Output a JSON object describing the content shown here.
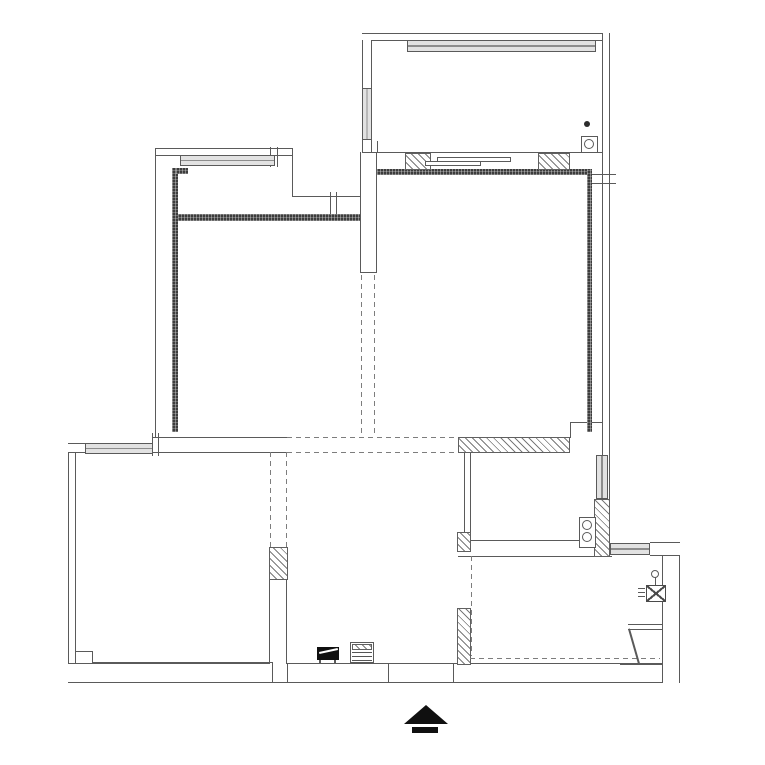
{
  "title": "apartment-floor-plan",
  "canvas": {
    "width": 765,
    "height": 765,
    "background": "#ffffff"
  },
  "colors": {
    "thin_line": "#5a5a5a",
    "stipple_wall": "#3c3c3c",
    "hatch_line": "#7a7a7a",
    "window_fill": "#e2e2e2",
    "dash_line": "#7d7d7d",
    "symbol_black": "#101010"
  },
  "elements": [
    {
      "cls": "band-h",
      "x": 362,
      "y": 33,
      "w": 248,
      "h": 8,
      "name": "balcony-north-wall"
    },
    {
      "cls": "band-v",
      "x": 602,
      "y": 33,
      "w": 8,
      "h": 510,
      "name": "east-outer-wall"
    },
    {
      "cls": "band-v",
      "x": 362,
      "y": 40,
      "w": 10,
      "h": 49,
      "name": "balcony-west-wall-upper"
    },
    {
      "cls": "band-v",
      "x": 362,
      "y": 139,
      "w": 10,
      "h": 14,
      "name": "balcony-west-wall-lower"
    },
    {
      "cls": "band-h",
      "x": 155,
      "y": 148,
      "w": 137,
      "h": 8,
      "name": "bedroom1-north-wall"
    },
    {
      "cls": "band-v",
      "x": 68,
      "y": 443,
      "w": 8,
      "h": 240,
      "name": "west-outer-wall"
    },
    {
      "cls": "band-h",
      "x": 68,
      "y": 663,
      "w": 612,
      "h": 20,
      "name": "south-outer-wall"
    },
    {
      "cls": "band-h",
      "x": 68,
      "y": 443,
      "w": 18,
      "h": 10,
      "name": "sw-corner-wall"
    },
    {
      "cls": "band-v",
      "x": 662,
      "y": 556,
      "w": 18,
      "h": 127,
      "name": "kitchen-east-wall"
    },
    {
      "cls": "band-h",
      "x": 650,
      "y": 542,
      "w": 30,
      "h": 14,
      "name": "kitchen-ne-corner-wall"
    },
    {
      "cls": "band-v",
      "x": 360,
      "y": 152,
      "w": 17,
      "h": 121,
      "name": "bedroom-divider-wall"
    },
    {
      "cls": "band-v",
      "x": 269,
      "y": 580,
      "w": 18,
      "h": 84,
      "name": "hall-divider-lower-wall"
    },
    {
      "cls": "band-v",
      "x": 464,
      "y": 453,
      "w": 7,
      "h": 79,
      "name": "bathroom-west-wall"
    },
    {
      "cls": "ln",
      "x": 155,
      "y": 148,
      "w": 1,
      "h": 290,
      "name": "west-upper-outer-line"
    },
    {
      "cls": "ln",
      "x": 292,
      "y": 148,
      "w": 1,
      "h": 49,
      "name": "bedroom1-step-line"
    },
    {
      "cls": "ln",
      "x": 292,
      "y": 196,
      "w": 69,
      "h": 1,
      "name": "bedroom1-step-line"
    },
    {
      "cls": "ln",
      "x": 362,
      "y": 152,
      "w": 241,
      "h": 1,
      "name": "balcony-inner-line"
    },
    {
      "cls": "ln",
      "x": 360,
      "y": 272,
      "w": 17,
      "h": 1,
      "name": "divider-wall-end"
    },
    {
      "cls": "ln",
      "x": 153,
      "y": 437,
      "w": 135,
      "h": 1,
      "name": "mid-boundary-line"
    },
    {
      "cls": "ln",
      "x": 153,
      "y": 452,
      "w": 135,
      "h": 1,
      "name": "mid-boundary-line"
    },
    {
      "cls": "ln",
      "x": 570,
      "y": 422,
      "w": 1,
      "h": 16,
      "name": "bathroom-step-line"
    },
    {
      "cls": "ln",
      "x": 570,
      "y": 422,
      "w": 33,
      "h": 1,
      "name": "bathroom-step-line"
    },
    {
      "cls": "ln",
      "x": 465,
      "y": 540,
      "w": 115,
      "h": 1,
      "name": "bathroom-south-line"
    },
    {
      "cls": "ln",
      "x": 458,
      "y": 556,
      "w": 154,
      "h": 1,
      "name": "kitchen-north-line"
    },
    {
      "cls": "ln",
      "x": 76,
      "y": 651,
      "w": 17,
      "h": 1,
      "name": "living-pilaster"
    },
    {
      "cls": "ln",
      "x": 92,
      "y": 651,
      "w": 1,
      "h": 13,
      "name": "living-pilaster"
    },
    {
      "cls": "ln",
      "x": 92,
      "y": 662,
      "w": 181,
      "h": 1,
      "name": "living-south-line"
    },
    {
      "cls": "ln",
      "x": 272,
      "y": 663,
      "w": 1,
      "h": 20,
      "name": "wall-joint"
    },
    {
      "cls": "ln",
      "x": 287,
      "y": 663,
      "w": 1,
      "h": 20,
      "name": "wall-joint"
    },
    {
      "cls": "ln",
      "x": 388,
      "y": 663,
      "w": 1,
      "h": 20,
      "name": "wall-joint"
    },
    {
      "cls": "ln",
      "x": 453,
      "y": 663,
      "w": 1,
      "h": 20,
      "name": "wall-joint"
    },
    {
      "cls": "ln",
      "x": 592,
      "y": 174,
      "w": 24,
      "h": 1,
      "name": "east-wall-tick"
    },
    {
      "cls": "ln",
      "x": 592,
      "y": 183,
      "w": 24,
      "h": 1,
      "name": "east-wall-tick"
    },
    {
      "cls": "ln",
      "x": 270,
      "y": 147,
      "w": 1,
      "h": 20,
      "name": "window-end-tick"
    },
    {
      "cls": "ln",
      "x": 277,
      "y": 147,
      "w": 1,
      "h": 20,
      "name": "window-end-tick"
    },
    {
      "cls": "ln",
      "x": 330,
      "y": 192,
      "w": 1,
      "h": 26,
      "name": "door-tick"
    },
    {
      "cls": "ln",
      "x": 336,
      "y": 192,
      "w": 1,
      "h": 26,
      "name": "door-tick"
    },
    {
      "cls": "ln",
      "x": 152,
      "y": 433,
      "w": 1,
      "h": 23,
      "name": "wall-tick"
    },
    {
      "cls": "ln",
      "x": 158,
      "y": 433,
      "w": 1,
      "h": 23,
      "name": "wall-tick"
    },
    {
      "cls": "ln",
      "x": 371,
      "y": 141,
      "w": 1,
      "h": 11,
      "name": "wall-tick"
    },
    {
      "cls": "ln",
      "x": 377,
      "y": 141,
      "w": 1,
      "h": 11,
      "name": "wall-tick"
    },
    {
      "cls": "ln",
      "x": 620,
      "y": 664,
      "w": 42,
      "h": 1,
      "name": "counter-base-line"
    },
    {
      "cls": "stip",
      "x": 377,
      "y": 169,
      "w": 215,
      "h": 6,
      "name": "bedroom2-north-stipple-wall"
    },
    {
      "cls": "stip",
      "x": 587,
      "y": 169,
      "w": 5,
      "h": 263,
      "name": "bedroom2-east-stipple-wall"
    },
    {
      "cls": "stip",
      "x": 172,
      "y": 168,
      "w": 6,
      "h": 264,
      "name": "bedroom1-west-stipple-wall"
    },
    {
      "cls": "stip",
      "x": 176,
      "y": 168,
      "w": 12,
      "h": 6,
      "name": "bedroom1-stipple-notch"
    },
    {
      "cls": "stip",
      "x": 178,
      "y": 214,
      "w": 182,
      "h": 7,
      "name": "bedroom1-inner-stipple-wall"
    },
    {
      "cls": "hatch",
      "x": 405,
      "y": 153,
      "w": 26,
      "h": 17,
      "name": "balcony-hatch-wall"
    },
    {
      "cls": "hatch",
      "x": 538,
      "y": 153,
      "w": 32,
      "h": 17,
      "name": "balcony-hatch-wall"
    },
    {
      "cls": "hatch",
      "x": 458,
      "y": 437,
      "w": 112,
      "h": 16,
      "name": "bathroom-north-hatch-wall"
    },
    {
      "cls": "hatch",
      "x": 594,
      "y": 499,
      "w": 16,
      "h": 58,
      "name": "bathroom-east-hatch-wall"
    },
    {
      "cls": "hatch",
      "x": 269,
      "y": 547,
      "w": 19,
      "h": 33,
      "name": "hall-divider-hatch-wall"
    },
    {
      "cls": "hatch",
      "x": 457,
      "y": 532,
      "w": 14,
      "h": 20,
      "name": "kitchen-west-hatch-wall"
    },
    {
      "cls": "hatch",
      "x": 457,
      "y": 608,
      "w": 14,
      "h": 57,
      "name": "kitchen-west-hatch-wall"
    },
    {
      "cls": "win-h",
      "x": 407,
      "y": 40,
      "w": 189,
      "h": 12,
      "name": "balcony-window"
    },
    {
      "cls": "win-v",
      "x": 362,
      "y": 88,
      "w": 10,
      "h": 52,
      "name": "balcony-side-window"
    },
    {
      "cls": "win-h",
      "x": 180,
      "y": 155,
      "w": 95,
      "h": 11,
      "name": "bedroom1-window"
    },
    {
      "cls": "win-h",
      "x": 85,
      "y": 443,
      "w": 68,
      "h": 11,
      "name": "living-room-window"
    },
    {
      "cls": "win-v",
      "x": 596,
      "y": 455,
      "w": 12,
      "h": 44,
      "name": "bathroom-window"
    },
    {
      "cls": "win-h",
      "x": 610,
      "y": 543,
      "w": 40,
      "h": 12,
      "name": "kitchen-window"
    },
    {
      "cls": "dash-v",
      "x": 361,
      "y": 275,
      "w": 1,
      "h": 162,
      "name": "removed-wall-dash"
    },
    {
      "cls": "dash-v",
      "x": 374,
      "y": 275,
      "w": 1,
      "h": 162,
      "name": "removed-wall-dash"
    },
    {
      "cls": "dash-h",
      "x": 287,
      "y": 437,
      "w": 171,
      "h": 1,
      "name": "removed-wall-dash"
    },
    {
      "cls": "dash-h",
      "x": 287,
      "y": 452,
      "w": 171,
      "h": 1,
      "name": "removed-wall-dash"
    },
    {
      "cls": "dash-v",
      "x": 270,
      "y": 452,
      "w": 1,
      "h": 95,
      "name": "removed-wall-dash"
    },
    {
      "cls": "dash-v",
      "x": 286,
      "y": 452,
      "w": 1,
      "h": 95,
      "name": "removed-wall-dash"
    },
    {
      "cls": "dash-v",
      "x": 471,
      "y": 556,
      "w": 1,
      "h": 100,
      "name": "removed-wall-dash"
    },
    {
      "cls": "dash-h",
      "x": 470,
      "y": 658,
      "w": 190,
      "h": 1,
      "name": "removed-wall-dash"
    },
    {
      "cls": "srect",
      "x": 437,
      "y": 157,
      "w": 74,
      "h": 5,
      "name": "sliding-door"
    },
    {
      "cls": "srect",
      "x": 425,
      "y": 161,
      "w": 56,
      "h": 5,
      "name": "sliding-door"
    },
    {
      "cls": "rect",
      "x": 581,
      "y": 136,
      "w": 17,
      "h": 17,
      "name": "floor-drain-icon"
    },
    {
      "cls": "circle",
      "x": 584,
      "y": 139,
      "w": 10,
      "h": 10,
      "name": "floor-drain-icon"
    },
    {
      "cls": "dot",
      "x": 584,
      "y": 121,
      "w": 6,
      "h": 6,
      "name": "faucet-point-icon"
    },
    {
      "cls": "rect",
      "x": 579,
      "y": 517,
      "w": 17,
      "h": 31,
      "name": "water-heater-icon"
    },
    {
      "cls": "circle",
      "x": 582,
      "y": 520,
      "w": 10,
      "h": 10,
      "name": "water-heater-icon"
    },
    {
      "cls": "circle",
      "x": 582,
      "y": 532,
      "w": 10,
      "h": 10,
      "name": "water-heater-icon"
    },
    {
      "cls": "circle",
      "x": 651,
      "y": 570,
      "w": 8,
      "h": 8,
      "name": "gas-meter-icon"
    },
    {
      "cls": "ln",
      "x": 655,
      "y": 577,
      "w": 1,
      "h": 9,
      "name": "gas-meter-icon"
    },
    {
      "cls": "xbox",
      "x": 646,
      "y": 585,
      "w": 20,
      "h": 17,
      "name": "gas-meter-icon"
    },
    {
      "cls": "ln",
      "x": 638,
      "y": 588,
      "w": 7,
      "h": 1,
      "name": "gas-meter-icon"
    },
    {
      "cls": "ln",
      "x": 638,
      "y": 592,
      "w": 7,
      "h": 1,
      "name": "gas-meter-icon"
    },
    {
      "cls": "ln",
      "x": 638,
      "y": 596,
      "w": 7,
      "h": 1,
      "name": "gas-meter-icon"
    },
    {
      "cls": "band-h",
      "x": 628,
      "y": 624,
      "w": 34,
      "h": 6,
      "name": "kitchen-counter"
    },
    {
      "cls": "ln",
      "x": 628,
      "y": 629,
      "w": 2,
      "h": 36,
      "rot": -16,
      "name": "kitchen-counter"
    },
    {
      "cls": "black",
      "x": 317,
      "y": 647,
      "w": 22,
      "h": 13,
      "name": "entry-console-symbol"
    },
    {
      "cls": "white-ln",
      "x": 319,
      "y": 652,
      "w": 19,
      "h": 2,
      "rot": -12,
      "name": "entry-console-symbol"
    },
    {
      "cls": "ln",
      "x": 319,
      "y": 660,
      "w": 2,
      "h": 3,
      "name": "entry-console-symbol"
    },
    {
      "cls": "ln",
      "x": 334,
      "y": 660,
      "w": 2,
      "h": 3,
      "name": "entry-console-symbol"
    },
    {
      "cls": "rect",
      "x": 350,
      "y": 642,
      "w": 24,
      "h": 21,
      "name": "entry-cabinet-symbol"
    },
    {
      "cls": "hatch",
      "x": 352,
      "y": 644,
      "w": 20,
      "h": 6,
      "name": "entry-cabinet-symbol"
    },
    {
      "cls": "hlines",
      "x": 352,
      "y": 652,
      "w": 20,
      "h": 10,
      "name": "entry-cabinet-symbol"
    },
    {
      "cls": "tri",
      "x": 404,
      "y": 705,
      "w": 44,
      "h": 19,
      "name": "entrance-arrow-icon"
    },
    {
      "cls": "black",
      "x": 412,
      "y": 727,
      "w": 26,
      "h": 6,
      "name": "entrance-arrow-icon"
    }
  ]
}
